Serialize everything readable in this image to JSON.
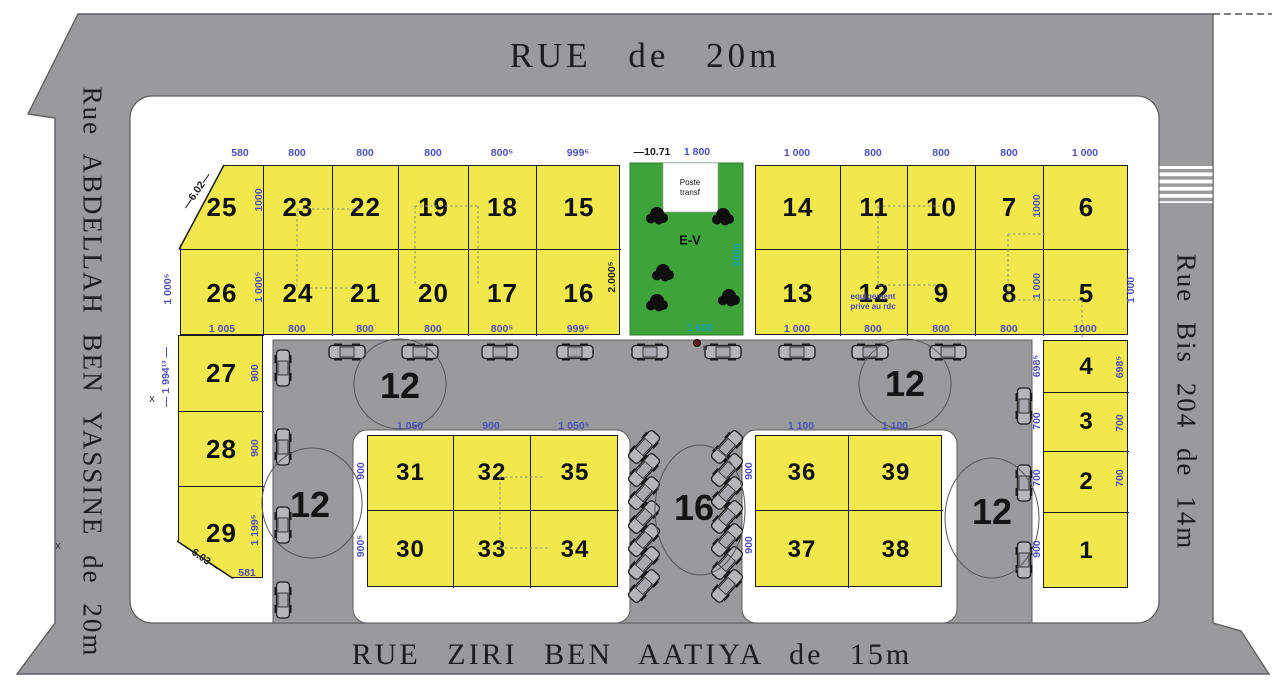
{
  "streets": {
    "top": "RUE de 20m",
    "bottom": "RUE ZIRI BEN AATIYA de 15m",
    "left": "Rue ABDELLAH BEN YASSINE de 20m",
    "right": "Rue Bis 204 de 14m"
  },
  "green_area": {
    "label": "E-V",
    "poste_label": "Poste\ntransf",
    "x": 630,
    "y": 163,
    "w": 113,
    "h": 172,
    "poste": {
      "x": 663,
      "y": 163,
      "w": 55,
      "h": 49
    },
    "trees": [
      [
        657,
        215
      ],
      [
        723,
        216
      ],
      [
        663,
        272
      ],
      [
        657,
        302
      ],
      [
        729,
        297
      ]
    ],
    "marker": {
      "x": 697,
      "y": 343,
      "label": "n"
    }
  },
  "blocks": [
    {
      "id": "nw",
      "x": 180,
      "y": 165,
      "cols": [
        83,
        69,
        66,
        70,
        68,
        84
      ],
      "rows": [
        84,
        86
      ],
      "lots": [
        [
          "25",
          "23",
          "22",
          "19",
          "18",
          "15"
        ],
        [
          "26",
          "24",
          "21",
          "20",
          "17",
          "16"
        ]
      ]
    },
    {
      "id": "ne",
      "x": 755,
      "y": 165,
      "cols": [
        85,
        67,
        68,
        68,
        85
      ],
      "rows": [
        84,
        86
      ],
      "lots": [
        [
          "14",
          "11",
          "10",
          "7",
          "6"
        ],
        [
          "13",
          "12",
          "9",
          "8",
          "5"
        ]
      ]
    },
    {
      "id": "w",
      "x": 178,
      "y": 335,
      "cols": [
        85
      ],
      "rows": [
        76,
        75,
        92
      ],
      "lots": [
        [
          "27"
        ],
        [
          "28"
        ],
        [
          "29"
        ]
      ]
    },
    {
      "id": "e",
      "x": 1043,
      "y": 340,
      "cols": [
        85
      ],
      "rows": [
        52,
        59,
        61,
        76
      ],
      "lots": [
        [
          "4"
        ],
        [
          "3"
        ],
        [
          "2"
        ],
        [
          "1"
        ]
      ]
    },
    {
      "id": "i1",
      "x": 367,
      "y": 435,
      "cols": [
        86,
        77,
        88
      ],
      "rows": [
        75,
        77
      ],
      "lots": [
        [
          "31",
          "32",
          "35"
        ],
        [
          "30",
          "33",
          "34"
        ]
      ]
    },
    {
      "id": "i2",
      "x": 755,
      "y": 435,
      "cols": [
        93,
        94
      ],
      "rows": [
        75,
        77
      ],
      "lots": [
        [
          "36",
          "39"
        ],
        [
          "37",
          "38"
        ]
      ]
    }
  ],
  "lot_note": {
    "lot": "12",
    "text": "equipement\nprivé au rdc",
    "x": 873,
    "y": 300
  },
  "dim_labels": [
    {
      "t": "580",
      "x": 240,
      "y": 153
    },
    {
      "t": "800",
      "x": 297,
      "y": 153
    },
    {
      "t": "800",
      "x": 365,
      "y": 153
    },
    {
      "t": "800",
      "x": 433,
      "y": 153
    },
    {
      "t": "800⁵",
      "x": 502,
      "y": 153
    },
    {
      "t": "999⁵",
      "x": 578,
      "y": 153
    },
    {
      "t": "1 005",
      "x": 222,
      "y": 329
    },
    {
      "t": "800",
      "x": 297,
      "y": 329
    },
    {
      "t": "800",
      "x": 365,
      "y": 329
    },
    {
      "t": "800",
      "x": 433,
      "y": 329
    },
    {
      "t": "800⁵",
      "x": 502,
      "y": 329
    },
    {
      "t": "999⁵",
      "x": 578,
      "y": 329
    },
    {
      "t": "1 000",
      "x": 797,
      "y": 153
    },
    {
      "t": "800",
      "x": 873,
      "y": 153
    },
    {
      "t": "800",
      "x": 941,
      "y": 153
    },
    {
      "t": "800",
      "x": 1009,
      "y": 153
    },
    {
      "t": "1 000",
      "x": 1085,
      "y": 153
    },
    {
      "t": "1 000",
      "x": 797,
      "y": 329
    },
    {
      "t": "800",
      "x": 873,
      "y": 329
    },
    {
      "t": "800",
      "x": 941,
      "y": 329
    },
    {
      "t": "800",
      "x": 1009,
      "y": 329
    },
    {
      "t": "1000",
      "x": 1085,
      "y": 329
    },
    {
      "t": "—10.71",
      "x": 652,
      "y": 152,
      "c": "k"
    },
    {
      "t": "1 800",
      "x": 697,
      "y": 152
    },
    {
      "t": "1000",
      "x": 259,
      "y": 200,
      "r": -90
    },
    {
      "t": "1 000⁵",
      "x": 259,
      "y": 287,
      "r": -90
    },
    {
      "t": "1 000⁵",
      "x": 168,
      "y": 289,
      "r": -90
    },
    {
      "t": "— 1 994¹³ —",
      "x": 166,
      "y": 377,
      "r": -90
    },
    {
      "t": "2.000⁵",
      "x": 612,
      "y": 277,
      "r": -90,
      "c": "k"
    },
    {
      "t": "2000",
      "x": 737,
      "y": 255,
      "r": -90,
      "c": "g"
    },
    {
      "t": "1000",
      "x": 1037,
      "y": 206,
      "r": -90
    },
    {
      "t": "1 000",
      "x": 1037,
      "y": 286,
      "r": -90
    },
    {
      "t": "1 000",
      "x": 1131,
      "y": 290,
      "r": -90
    },
    {
      "t": "900",
      "x": 255,
      "y": 373,
      "r": -90
    },
    {
      "t": "900",
      "x": 255,
      "y": 448,
      "r": -90
    },
    {
      "t": "1 199⁵",
      "x": 255,
      "y": 530,
      "r": -90
    },
    {
      "t": "698⁵",
      "x": 1037,
      "y": 366,
      "r": -90
    },
    {
      "t": "700",
      "x": 1037,
      "y": 421,
      "r": -90
    },
    {
      "t": "700",
      "x": 1037,
      "y": 478,
      "r": -90
    },
    {
      "t": "900",
      "x": 1037,
      "y": 549,
      "r": -90
    },
    {
      "t": "698⁵",
      "x": 1120,
      "y": 367,
      "r": -90
    },
    {
      "t": "700",
      "x": 1120,
      "y": 423,
      "r": -90
    },
    {
      "t": "700",
      "x": 1120,
      "y": 478,
      "r": -90
    },
    {
      "t": "900",
      "x": 361,
      "y": 471,
      "r": -90
    },
    {
      "t": "900⁵",
      "x": 361,
      "y": 546,
      "r": -90
    },
    {
      "t": "900",
      "x": 749,
      "y": 471,
      "r": -90
    },
    {
      "t": "900",
      "x": 749,
      "y": 545,
      "r": -90
    },
    {
      "t": "1 050",
      "x": 410,
      "y": 426
    },
    {
      "t": "900",
      "x": 491,
      "y": 426
    },
    {
      "t": "1 050⁵",
      "x": 574,
      "y": 426
    },
    {
      "t": "1 100",
      "x": 801,
      "y": 426
    },
    {
      "t": "1 100",
      "x": 895,
      "y": 426
    },
    {
      "t": "1 600",
      "x": 700,
      "y": 328,
      "c": "g"
    },
    {
      "t": "581",
      "x": 247,
      "y": 573
    },
    {
      "t": "—6.02—",
      "x": 197,
      "y": 191,
      "r": -55,
      "c": "k"
    },
    {
      "t": "—6.03—",
      "x": 201,
      "y": 557,
      "r": 35,
      "c": "k"
    }
  ],
  "circle_labels": [
    {
      "t": "12",
      "x": 400,
      "y": 386
    },
    {
      "t": "12",
      "x": 905,
      "y": 384
    },
    {
      "t": "12",
      "x": 310,
      "y": 505
    },
    {
      "t": "12",
      "x": 992,
      "y": 512
    },
    {
      "t": "16",
      "x": 694,
      "y": 508
    }
  ],
  "circles": [
    {
      "cx": 400,
      "cy": 384,
      "rx": 46,
      "ry": 45
    },
    {
      "cx": 905,
      "cy": 384,
      "rx": 46,
      "ry": 45
    },
    {
      "cx": 312,
      "cy": 503,
      "rx": 50,
      "ry": 55
    },
    {
      "cx": 992,
      "cy": 518,
      "rx": 47,
      "ry": 60
    },
    {
      "cx": 700,
      "cy": 510,
      "rx": 45,
      "ry": 65
    }
  ],
  "survey_marks": [
    {
      "t": "x",
      "x": 152,
      "y": 399
    },
    {
      "t": "x",
      "x": 58,
      "y": 546
    }
  ],
  "cars": {
    "top_row": {
      "y": 352,
      "r": 0,
      "xs": [
        347,
        420,
        500,
        575,
        650,
        723,
        797,
        870,
        948
      ]
    },
    "left_leg": {
      "x": 283,
      "r": 90,
      "ys": [
        368,
        447,
        525,
        600
      ]
    },
    "right_leg": {
      "x": 1024,
      "r": 90,
      "ys": [
        406,
        483,
        560
      ]
    },
    "mid_left": {
      "x": 644,
      "r": -48,
      "ys": [
        447,
        470,
        493,
        517,
        540,
        563,
        586
      ]
    },
    "mid_right": {
      "x": 727,
      "r": -48,
      "ys": [
        447,
        470,
        493,
        517,
        540,
        563,
        586
      ]
    }
  },
  "dashes": [
    [
      297,
      209,
      362,
      209
    ],
    [
      297,
      209,
      297,
      288
    ],
    [
      310,
      288,
      358,
      288
    ],
    [
      415,
      206,
      478,
      206
    ],
    [
      415,
      206,
      415,
      286
    ],
    [
      478,
      206,
      478,
      284
    ],
    [
      878,
      206,
      940,
      206
    ],
    [
      878,
      206,
      878,
      285
    ],
    [
      878,
      285,
      938,
      285
    ],
    [
      1008,
      234,
      1045,
      234
    ],
    [
      1008,
      234,
      1008,
      300
    ],
    [
      1008,
      300,
      1082,
      300
    ],
    [
      1082,
      300,
      1082,
      338
    ],
    [
      500,
      477,
      545,
      477
    ],
    [
      500,
      477,
      500,
      548
    ],
    [
      500,
      548,
      548,
      548
    ]
  ],
  "colors": {
    "street": "#9a9a9d",
    "lot_fill": "#f0e84d",
    "green": "#3fa33c",
    "green_border": "#2e7d2e",
    "dim_blue": "#5050bb",
    "dim_teal": "#18a0a8",
    "ink": "#1b1b1b",
    "edge": "#5f5f64",
    "car_fill": "#b5b5b8",
    "white": "#ffffff"
  }
}
